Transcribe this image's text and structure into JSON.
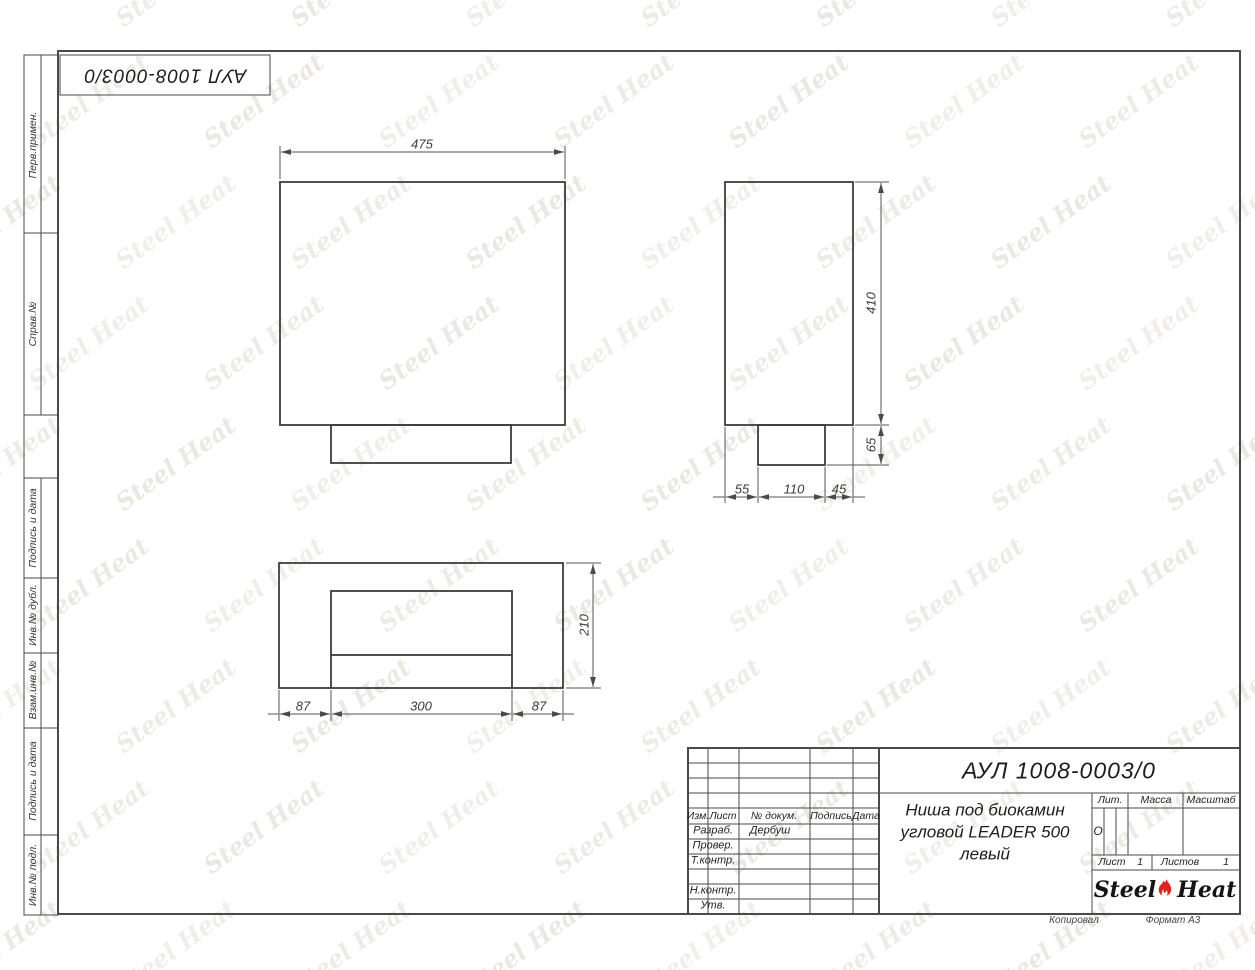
{
  "title_block": {
    "doc_number": "АУЛ 1008-0003/0",
    "name_lines": [
      "Ниша под биокамин",
      "угловой LEADER 500",
      "левый"
    ],
    "change_header": [
      "Изм.",
      "Лист",
      "№ докум.",
      "Подпись",
      "Дата"
    ],
    "sig_rows": [
      {
        "label": "Разраб.",
        "value": "Дербуш"
      },
      {
        "label": "Провер.",
        "value": ""
      },
      {
        "label": "Т.контр.",
        "value": ""
      },
      {
        "label": "Н.контр.",
        "value": ""
      },
      {
        "label": "Утв.",
        "value": ""
      }
    ],
    "lit_label": "Лит.",
    "lit_value": "О",
    "massa_label": "Масса",
    "masshtab_label": "Масштаб",
    "list_label": "Лист",
    "list_value": "1",
    "listov_label": "Листов",
    "listov_value": "1",
    "footer_copy": "Копировал",
    "footer_format": "Формат А3"
  },
  "sidebar": {
    "labels": [
      "Перв.примен.",
      "Справ.№",
      "Подпись и дата",
      "Инв.№ дубл.",
      "Взам.инв.№",
      "Подпись и дата",
      "Инв.№ подл."
    ]
  },
  "drawing": {
    "front": {
      "width": "475"
    },
    "side": {
      "height": "410",
      "tab_height": "65",
      "seg_left": "55",
      "seg_mid": "110",
      "seg_right": "45"
    },
    "top": {
      "depth": "210",
      "seg_left": "87",
      "seg_mid": "300",
      "seg_right": "87"
    }
  },
  "logo": {
    "steel": "Steel",
    "heat": "Heat"
  },
  "watermark": {
    "text": "Steel Heat"
  },
  "colors": {
    "flame_red": "#e0241b",
    "line": "#4a4a4a"
  }
}
